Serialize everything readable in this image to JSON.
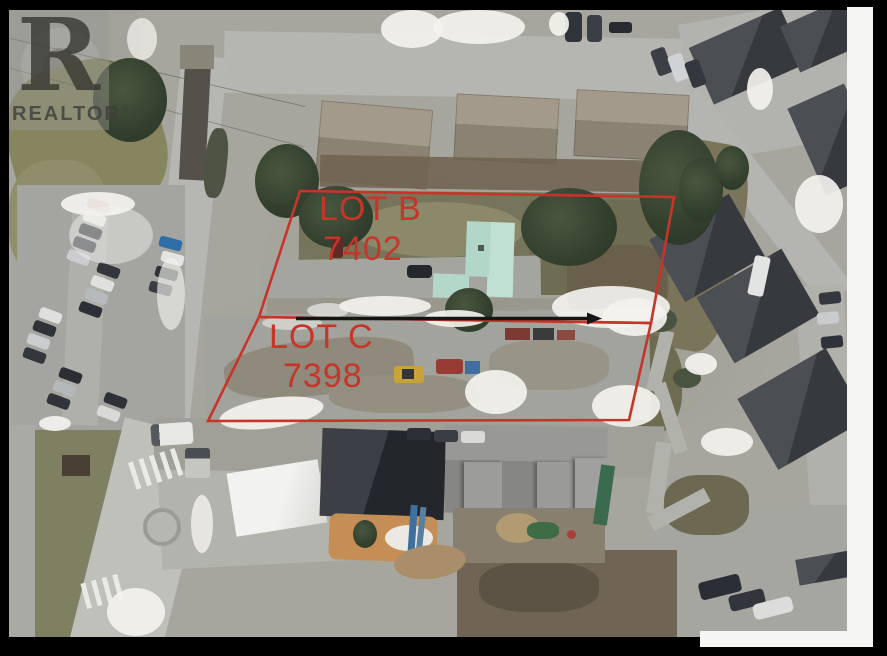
{
  "watermark": {
    "logo_letter": "R",
    "brand": "REALTOR",
    "registered": "®"
  },
  "annotations": {
    "accent_color": "#c5352a",
    "arrow_color": "#151515",
    "lots": [
      {
        "name": "LOT B",
        "number": "7402",
        "points": "291,181 665,187 642,313 250,307"
      },
      {
        "name": "LOT C",
        "number": "7398",
        "points": "250,307 642,313 620,410 199,411"
      }
    ],
    "arrow_shaft": "M287,308.5 H578",
    "arrow_head": "578,302.5 593,308.5 578,314.5"
  },
  "palette": {
    "photo_base": "#a7a69e",
    "green_roof": "#b9dccf",
    "dark_roof": "#3a3d43",
    "shingle_roof": "#978e80",
    "grass": "#7e8061",
    "road": "#b5b5b1",
    "sand": "#c58e55",
    "snow": "#f3f2ee",
    "frame": "#000000",
    "page_edge": "#f5f5f3"
  }
}
